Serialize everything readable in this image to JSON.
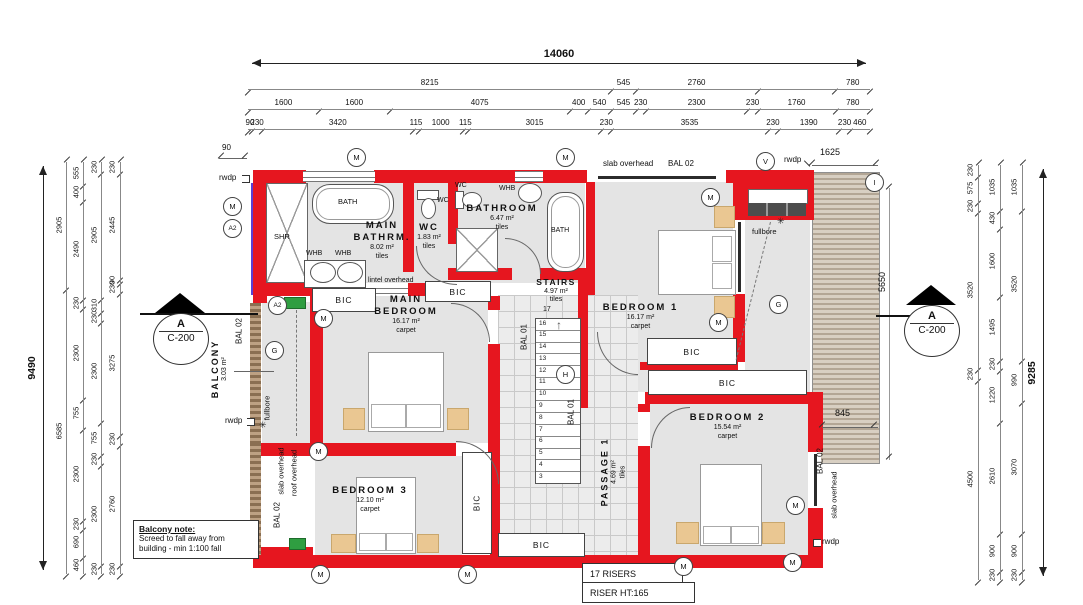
{
  "dims": {
    "top": {
      "overall": "14060",
      "row2": [
        "8215",
        "545",
        "2760",
        "~1760",
        "780"
      ],
      "row3": [
        "1600",
        "1600",
        "4075",
        "400",
        "540",
        "545",
        "230",
        "2300",
        "230",
        "1760",
        "780"
      ],
      "row4": [
        "90",
        "230",
        "3420",
        "115",
        "1000",
        "115",
        "3015",
        "230",
        "3535",
        "230",
        "1390",
        "230",
        "460"
      ]
    },
    "left": {
      "overall": "9490",
      "col2": [
        "2905",
        "6585"
      ],
      "col3": [
        "555",
        "400",
        "2490",
        "230",
        "2300",
        "755",
        "2300",
        "230",
        "690",
        "460"
      ],
      "col4": [
        "230",
        "2905",
        "310",
        "230",
        "2300",
        "755",
        "230",
        "2300",
        "230"
      ],
      "col5": [
        "230",
        "2445",
        "90",
        "230",
        "3275",
        "230",
        "2760",
        "230"
      ]
    },
    "right": {
      "overall": "9285",
      "col_inner": [
        "230",
        "575",
        "230",
        "3520",
        "230",
        "4500"
      ],
      "col_mid": [
        "1035",
        "430",
        "1600",
        "1495",
        "230",
        "1220",
        "2610",
        "900",
        "230"
      ],
      "col_outer": [
        "1035",
        "3520",
        "990",
        "3070",
        "900",
        "230"
      ]
    },
    "inplan": {
      "d90": "90",
      "d1625": "1625",
      "d5650": "5650",
      "d845": "845"
    }
  },
  "rooms": {
    "main_bathrm": {
      "name": "MAIN BATHRM.",
      "area": "8.02 m²",
      "floor": "tiles"
    },
    "wc": {
      "name": "WC",
      "area": "1.83 m²",
      "floor": "tiles"
    },
    "bathroom": {
      "name": "BATHROOM",
      "area": "6.47 m²",
      "floor": "tiles"
    },
    "stairs": {
      "name": "STAIRS",
      "area": "4.97 m²",
      "floor": "tiles"
    },
    "bedroom1": {
      "name": "BEDROOM 1",
      "area": "16.17 m²",
      "floor": "carpet"
    },
    "main_bedroom": {
      "name": "MAIN BEDROOM",
      "area": "16.17 m²",
      "floor": "carpet"
    },
    "bedroom2": {
      "name": "BEDROOM 2",
      "area": "15.54 m²",
      "floor": "carpet"
    },
    "bedroom3": {
      "name": "BEDROOM 3",
      "area": "12.10 m²",
      "floor": "carpet"
    },
    "passage": {
      "name": "PASSAGE 1",
      "area": "4.69 m²",
      "floor": "tiles"
    },
    "balcony": {
      "name": "BALCONY",
      "area": "3.03 m²"
    }
  },
  "fixtures": {
    "shr": "SHR",
    "bath": "BATH",
    "whb": "WHB",
    "wc": "WC",
    "bic": "BIC"
  },
  "labels": {
    "slab_overhead": "slab overhead",
    "roof_overhead": "roof overhead",
    "bal01": "BAL 01",
    "bal02": "BAL 02",
    "rwdp": "rwdp",
    "fullbore": "fullbore",
    "lintel": "lintel overhead"
  },
  "markers": {
    "m": "M",
    "a2": "A2",
    "v": "V",
    "i": "I",
    "g": "G",
    "h": "H"
  },
  "section": {
    "letter": "A",
    "ref": "C-200"
  },
  "stairs": {
    "top_number": "17",
    "treads": [
      "16",
      "15",
      "14",
      "13",
      "12",
      "11",
      "10",
      "9",
      "8",
      "7",
      "6",
      "5",
      "4",
      "3"
    ]
  },
  "notes": {
    "balcony": {
      "title": "Balcony note:",
      "line1": "Screed to fall away from",
      "line2": "building - min 1:100 fall"
    },
    "risers": {
      "line1": "17 RISERS",
      "line2": "RISER HT:165"
    }
  }
}
